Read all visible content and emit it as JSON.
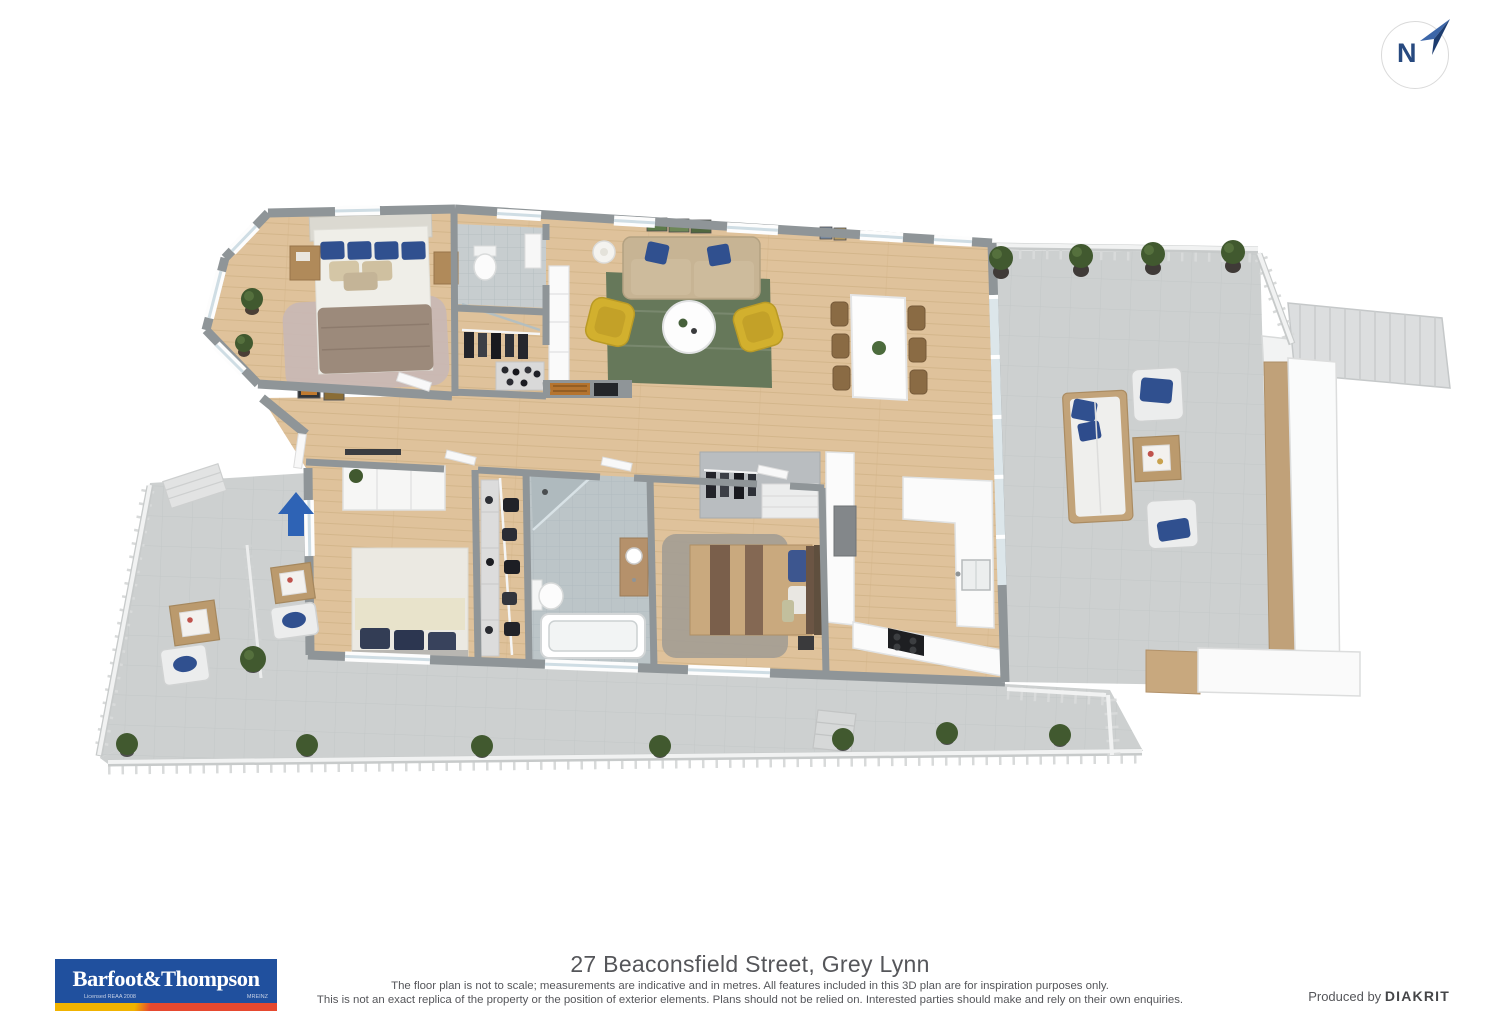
{
  "compass": {
    "label": "N"
  },
  "footer": {
    "title": "27 Beaconsfield Street, Grey Lynn",
    "disclaimer_line1": "The floor plan is not to scale; measurements are indicative and in metres. All features included in this 3D plan are for inspiration purposes only.",
    "disclaimer_line2": "This is not an exact replica of the property or the position of exterior elements. Plans should not be relied on. Interested parties should make and rely on their own enquiries.",
    "produced_by_label": "Produced by",
    "producer_name": "DIAKRIT"
  },
  "logo": {
    "brand": "Barfoot&Thompson",
    "licensed": "Licensed REAA 2008",
    "affiliation": "MREINZ"
  },
  "colors": {
    "accent_blue": "#2e63b5",
    "compass_navy": "#27497f",
    "wood_floor": "#dfc29b",
    "deck_tile": "#cdd0d0",
    "wall_gray": "#8f9598",
    "rug_green": "#66785a",
    "rug_pink": "#c8b8b5",
    "rug_gray": "#a39d94",
    "sofa_beige": "#c7b494",
    "chair_yellow": "#d2b02e",
    "pillow_blue": "#30508f",
    "bed_taupe": "#9c8a7b",
    "bed_brown": "#c9a97e",
    "furniture_wood": "#b08a5a",
    "plant_green": "#41592f",
    "logo_blue": "#20509e",
    "stripe_yellow": "#f1b300",
    "stripe_red": "#e6492f",
    "text_gray": "#55565a"
  }
}
